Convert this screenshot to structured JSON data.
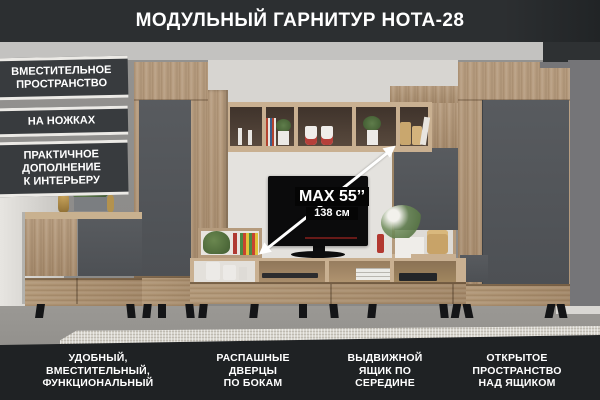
{
  "title": "МОДУЛЬНЫЙ ГАРНИТУР НОТА-28",
  "left_labels": [
    {
      "lines": [
        "ВМЕСТИТЕЛЬНОЕ",
        "ПРОСТРАНСТВО"
      ]
    },
    {
      "lines": [
        "НА НОЖКАХ"
      ]
    },
    {
      "lines": [
        "ПРАКТИЧНОЕ",
        "ДОПОЛНЕНИЕ",
        "К ИНТЕРЬЕРУ"
      ]
    }
  ],
  "bottom_labels": [
    {
      "lines": [
        "УДОБНЫЙ,",
        "ВМЕСТИТЕЛЬНЫЙ,",
        "ФУНКЦИОНАЛЬНЫЙ"
      ]
    },
    {
      "lines": [
        "РАСПАШНЫЕ",
        "ДВЕРЦЫ",
        "ПО БОКАМ"
      ]
    },
    {
      "lines": [
        "ВЫДВИЖНОЙ",
        "ЯЩИК ПО",
        "СЕРЕДИНЕ"
      ]
    },
    {
      "lines": [
        "ОТКРЫТОЕ",
        "ПРОСТРАНСТВО",
        "НАД ЯЩИКОМ"
      ]
    }
  ],
  "tv": {
    "size_label": "MAX 55’’",
    "diagonal_label": "138 см"
  },
  "colors": {
    "wood": "#b0977a",
    "panel_grey": "#54575b",
    "header_bar": "#2c2f31",
    "footer_bar": "#1f2224",
    "label_box": "#383b3e"
  }
}
